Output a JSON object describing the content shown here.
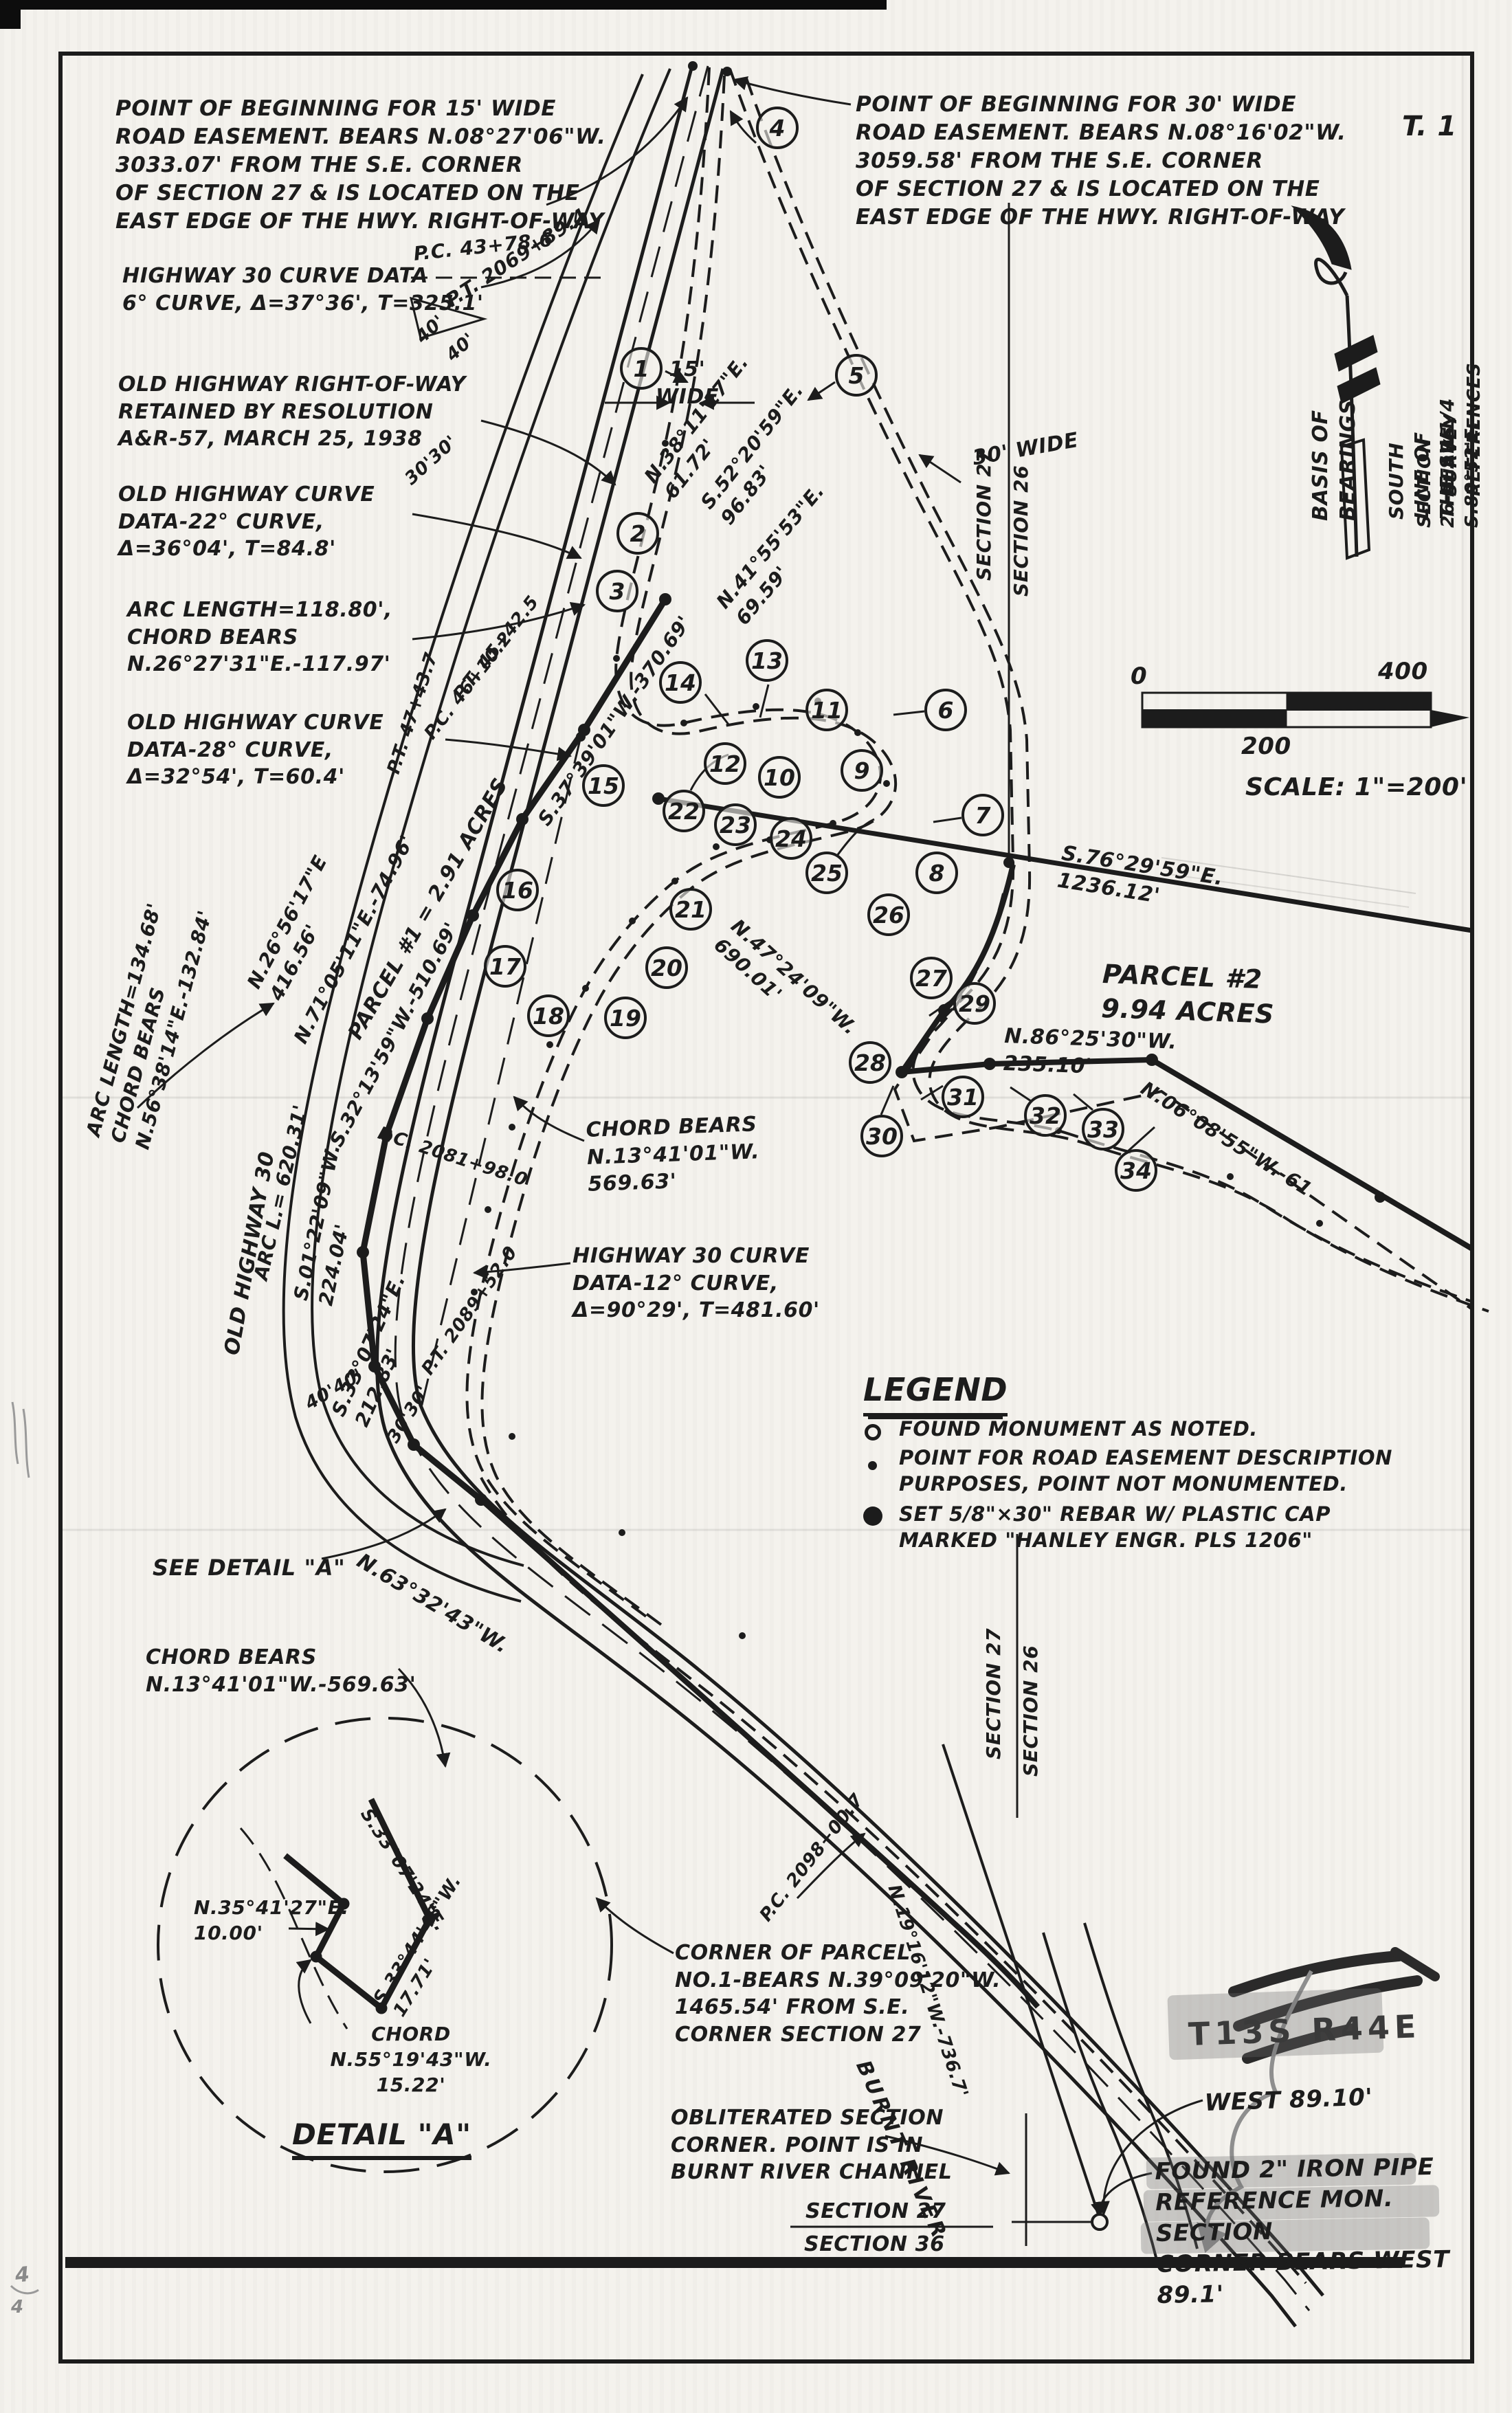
{
  "sheet": {
    "township_tag": "T. 1",
    "scale_text": "SCALE: 1\"=200'",
    "tick_0": "0",
    "tick_200": "200",
    "tick_400": "400"
  },
  "notes": {
    "pob15": "POINT OF BEGINNING FOR 15' WIDE\nROAD EASEMENT. BEARS N.08°27'06\"W.\n3033.07' FROM THE S.E. CORNER\nOF SECTION 27 & IS LOCATED ON THE\nEAST EDGE OF THE HWY. RIGHT-OF-WAY",
    "pob30": "POINT OF BEGINNING FOR 30' WIDE\nROAD EASEMENT. BEARS N.08°16'02\"W.\n3059.58' FROM THE S.E. CORNER\nOF SECTION 27 & IS LOCATED ON THE\nEAST EDGE OF THE HWY. RIGHT-OF-WAY",
    "hwy30_curve_6": "HIGHWAY 30 CURVE DATA\n6° CURVE, Δ=37°36', T=325.1'",
    "old_row": "OLD HIGHWAY RIGHT-OF-WAY\nRETAINED BY RESOLUTION\nA&R-57, MARCH 25, 1938",
    "old_curve_22": "OLD HIGHWAY CURVE\nDATA-22° CURVE,\nΔ=36°04', T=84.8'",
    "arc_118": "ARC LENGTH=118.80',\nCHORD BEARS\nN.26°27'31\"E.-117.97'",
    "old_curve_28": "OLD HIGHWAY CURVE\nDATA-28° CURVE,\nΔ=32°54', T=60.4'",
    "arc_134": "ARC LENGTH=134.68'\nCHORD BEARS\nN.56°38'14\"E.-132.84'",
    "chord_569": "CHORD BEARS\nN.13°41'01\"W.\n569.63'",
    "hwy30_curve_12": "HIGHWAY 30 CURVE\nDATA-12° CURVE,\nΔ=90°29', T=481.60'",
    "see_detail_a": "SEE DETAIL \"A\"",
    "chord_569_b": "CHORD BEARS\nN.13°41'01\"W.-569.63'",
    "corner_parcel_1": "CORNER OF PARCEL\nNO.1-BEARS N.39°09'20\"W.\n1465.54' FROM S.E.\nCORNER SECTION 27",
    "obliterated": "OBLITERATED SECTION\nCORNER. POINT IS IN\nBURNT RIVER CHANNEL",
    "found_pipe": "FOUND 2\" IRON PIPE\nREFERENCE MON. SECTION\nCORNER BEARS WEST 89.1'",
    "t13s_r44e": "T13S R44E",
    "west_89": "WEST 89.10'"
  },
  "bearings": {
    "n3811": "N.38°11'17\"E.\n61.72'",
    "s5220": "S.52°20'59\"E.\n96.83'",
    "n4155": "N.41°55'53\"E.\n69.59'",
    "n2656": "N.26°56'17\"E\n416.56'",
    "n7105": "N.71°05'11\"E.-74.96'",
    "s3739": "S.37°39'01\"W.-370.69'",
    "s3213": "S.32°13'59\"W.-510.69'",
    "s0122": "S.01°22'09\"W.\n224.04'",
    "arc_620": "ARC L.= 620.31'",
    "s3307_212": "S.33°07'24\"E.\n212.83'",
    "n4724": "N.47°24'09\"W.\n690.01'",
    "s7629": "S.76°29'59\"E.\n1236.12'",
    "n8625": "N.86°25'30\"W.\n235.10'",
    "n0608": "N.06°08'55\"W.-61",
    "n6332": "N.63°32'43\"W.",
    "n1916": "N.19°16'12\"W.-736.7'"
  },
  "stations": {
    "pt_2069": "P.T. 2069+89.4",
    "pc_43": "P.C. 43+78.6",
    "pt_45": "P.T. 45+42.5",
    "pc_46": "P.C. 46+10.2",
    "pt_47": "P.T. 47+43.7",
    "pc_2081": "P.C. 2081+98.0",
    "pt_2089": "P.T. 2089+52.0",
    "pc_2098": "P.C. 2098+00.7"
  },
  "widths": {
    "w15": "15'\nWIDE",
    "w30": "30' WIDE",
    "d40": "40'",
    "d40b": "40'",
    "d3030": "30'30'",
    "d4040": "40'40'",
    "d3030b": "30'30'"
  },
  "parcels": {
    "p1": "PARCEL #1 = 2.91 ACRES",
    "p2": "PARCEL #2\n9.94 ACRES"
  },
  "sections": {
    "s27": "SECTION 27",
    "s26": "SECTION 26",
    "s36": "SECTION 36"
  },
  "features": {
    "old_highway": "OLD HIGHWAY 30",
    "river": "BURNT RIVER"
  },
  "basis": {
    "l1": "BASIS OF BEARINGS",
    "l2": "SOUTH LINE OF THE SW1/4",
    "l3": "SECTION 26-BEARS S.89°52'E.",
    "l4": "SURVEY REFERENCES"
  },
  "detail_a": {
    "title": "DETAIL \"A\"",
    "n3541": "N.35°41'27\"E.\n10.00'",
    "s3307": "S.33°07'24\"E.",
    "s3344": "S.33°44'48\"W.\n17.71'",
    "chord": "CHORD N.55°19'43\"W.\n15.22'"
  },
  "legend": {
    "title": "LEGEND",
    "items": [
      {
        "symbol": "open-circle",
        "text": "FOUND MONUMENT AS NOTED."
      },
      {
        "symbol": "small-dot",
        "text": "POINT FOR ROAD EASEMENT DESCRIPTION\nPURPOSES, POINT NOT MONUMENTED."
      },
      {
        "symbol": "filled-circle",
        "text": "SET 5/8\"×30\" REBAR W/ PLASTIC CAP\nMARKED \"HANLEY ENGR. PLS 1206\""
      }
    ]
  },
  "balloons": [
    "1",
    "2",
    "3",
    "4",
    "5",
    "6",
    "7",
    "8",
    "9",
    "10",
    "11",
    "12",
    "13",
    "14",
    "15",
    "16",
    "17",
    "18",
    "19",
    "20",
    "21",
    "22",
    "23",
    "24",
    "25",
    "26",
    "27",
    "28",
    "29",
    "30",
    "31",
    "32",
    "33",
    "34"
  ],
  "marks": {
    "pencil_a": "4",
    "pencil_b": "4"
  },
  "colors": {
    "ink": "#1c1c1c",
    "paper": "#f4f2ed",
    "highlight": "#6a6a6a"
  }
}
